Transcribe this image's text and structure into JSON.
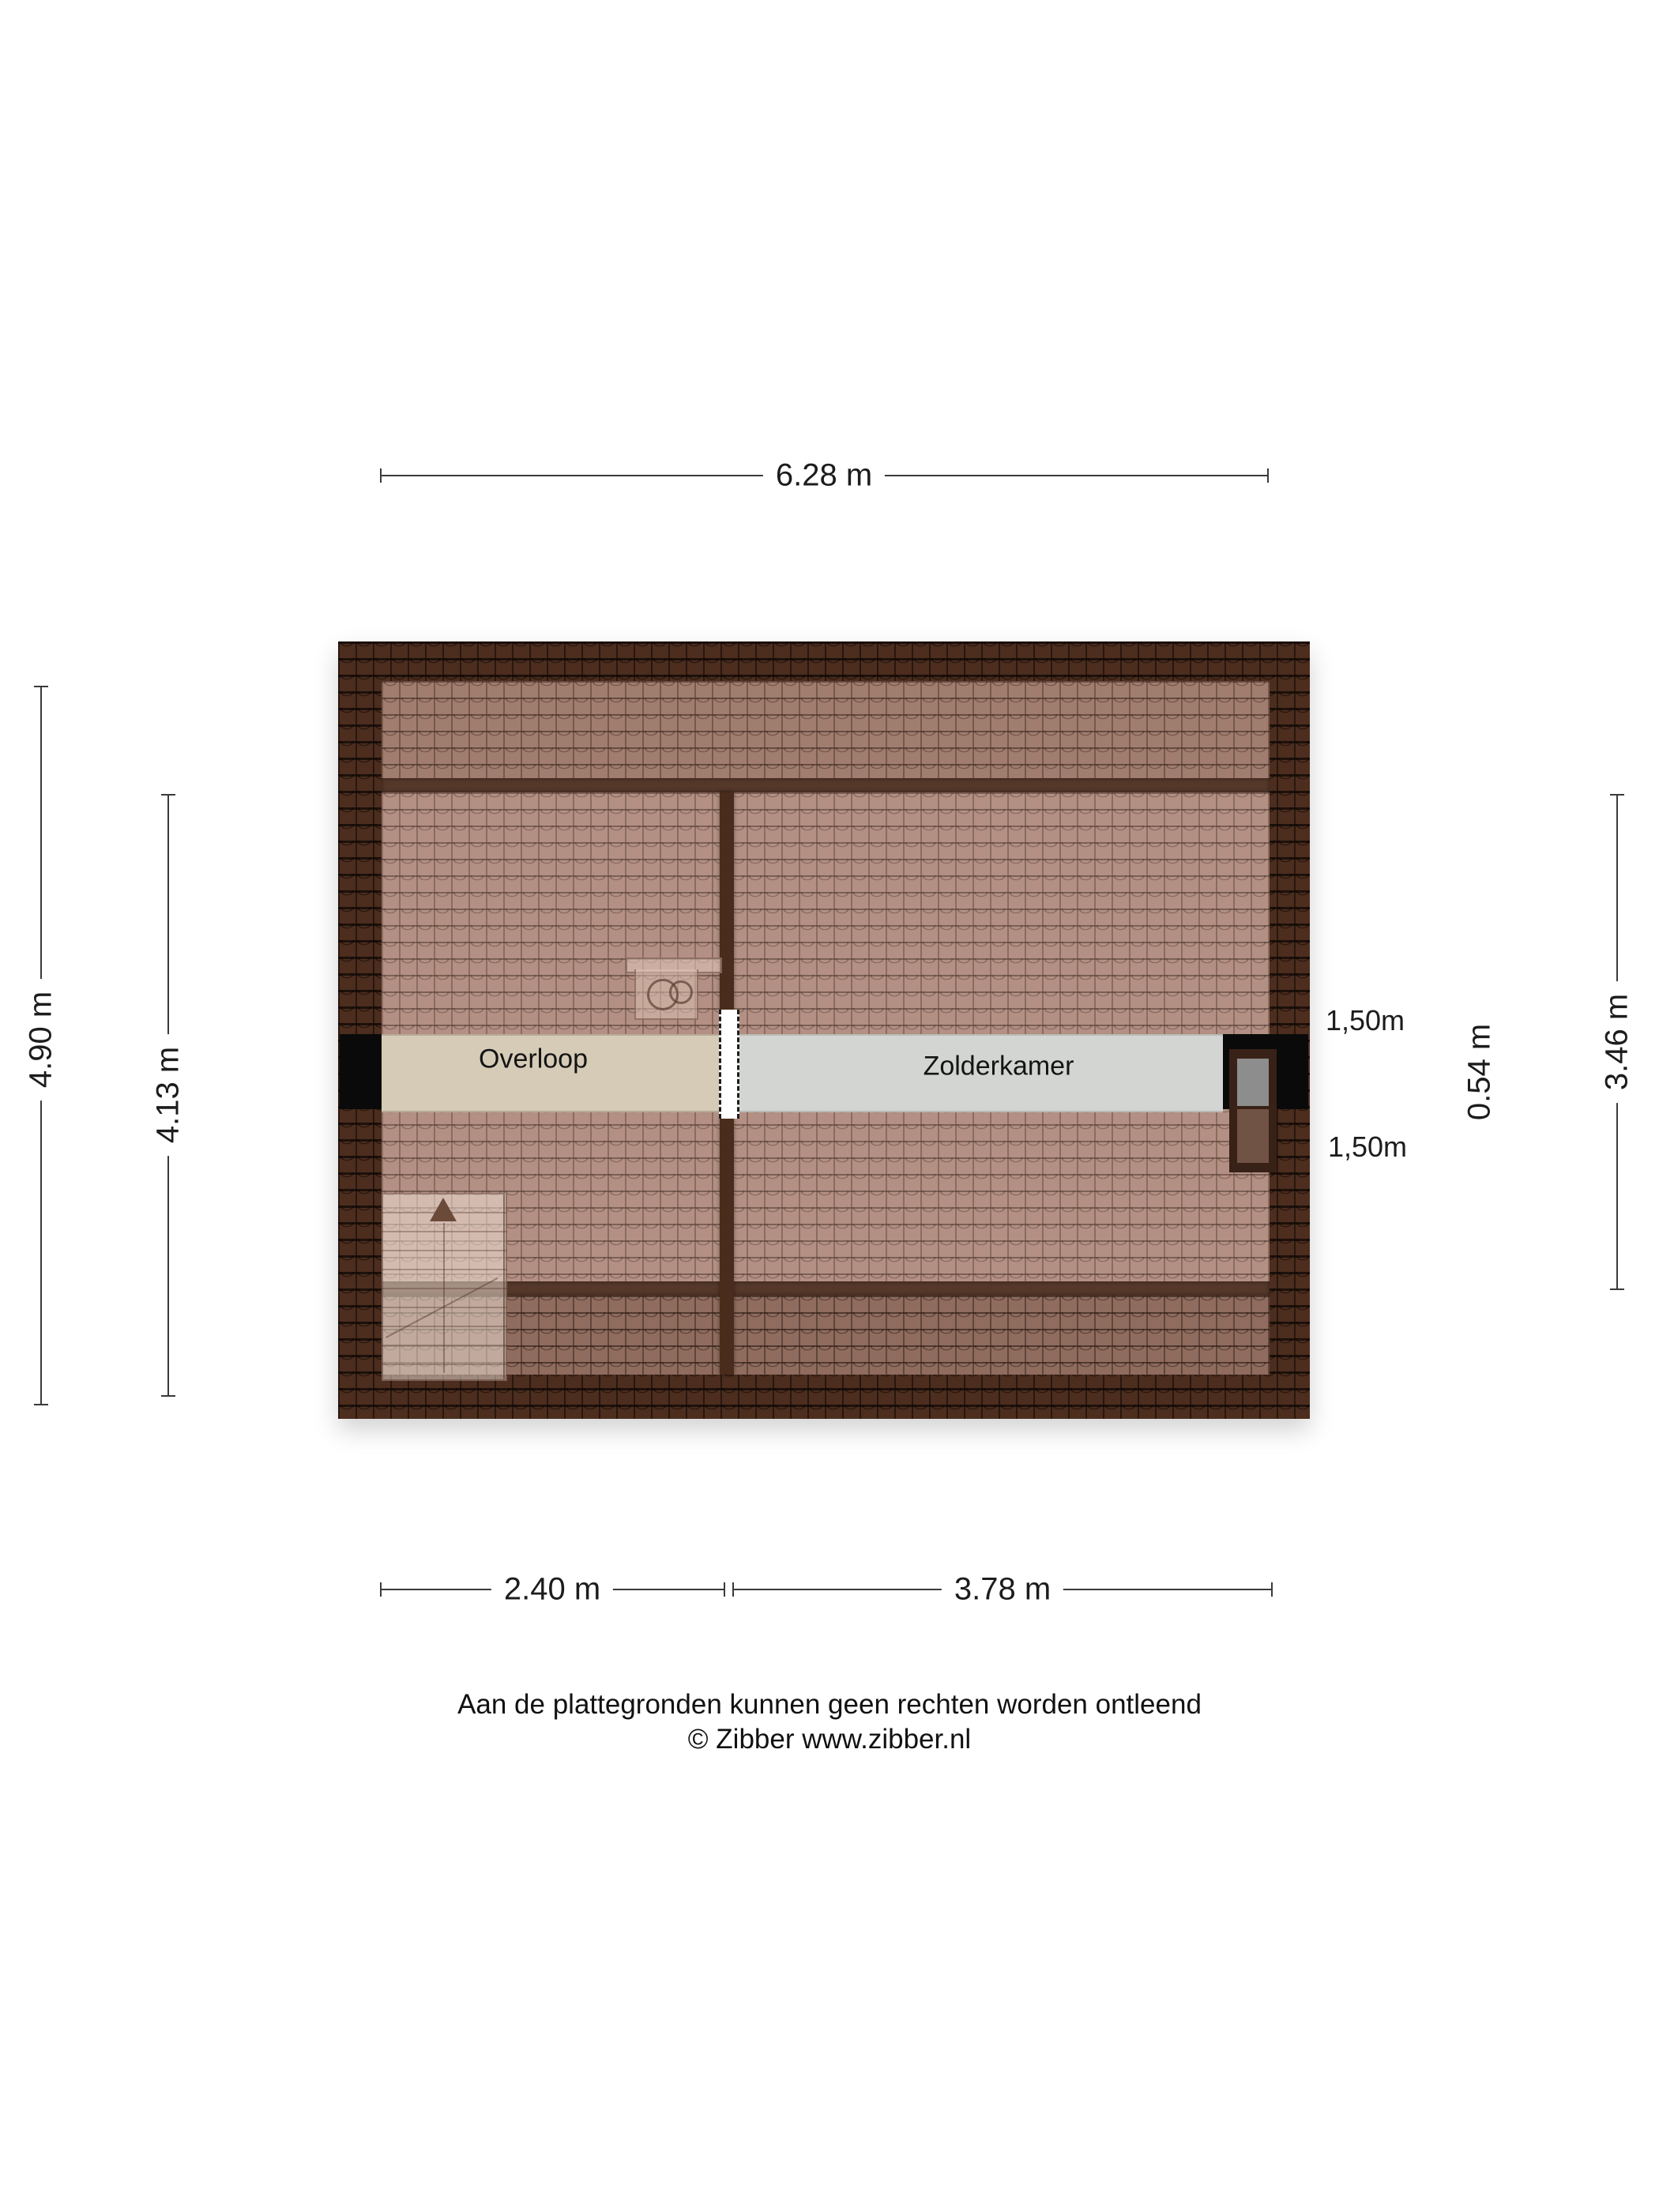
{
  "plan": {
    "type": "floorplan-attic",
    "rooms": {
      "overloop": {
        "label": "Overloop",
        "floor_color": "#d6cbb6"
      },
      "zolderkamer": {
        "label": "Zolderkamer",
        "floor_color": "#d3d5d2"
      }
    },
    "features": [
      "roof-tiles",
      "staircase-with-up-arrow",
      "sink-fixture",
      "dormer-window",
      "door-opening"
    ]
  },
  "dimensions": {
    "top_width": "6.28 m",
    "left_outer_depth": "4.90 m",
    "left_inner_depth": "4.13 m",
    "right_small_depth": "0.54 m",
    "right_inner_depth": "3.46 m",
    "bottom_left_width": "2.40 m",
    "bottom_right_width": "3.78 m",
    "dormer_width_top": "1,50m",
    "dormer_width_bottom": "1,50m"
  },
  "footer": {
    "line1": "Aan de plattegronden kunnen geen rechten worden ontleend",
    "line2": "© Zibber www.zibber.nl"
  },
  "colors": {
    "roof_border_dark": "#4c2d1e",
    "roof_top_band": "#a17d6f",
    "roof_main": "#b39083",
    "roof_lower_band": "#8f6c5e",
    "overloop_floor": "#d6cbb6",
    "zolderkamer_floor": "#d3d5d2",
    "wall_black": "#0a0a0a",
    "dimension_line": "#3a3a3a",
    "background": "#ffffff"
  }
}
